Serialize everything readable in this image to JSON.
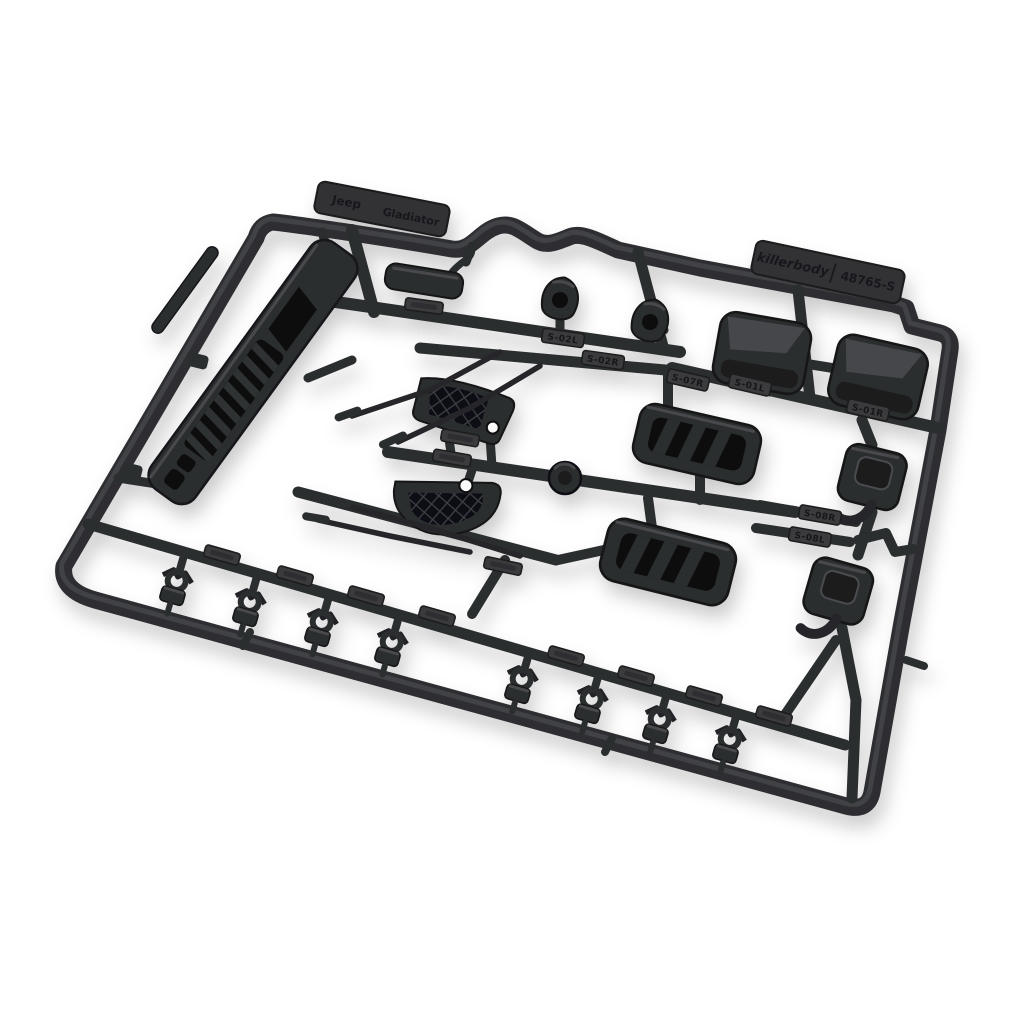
{
  "meta": {
    "type": "product-photograph",
    "subject": "black injection-molded plastic parts sprue (RC car body accessory tree) on white background",
    "background": "#ffffff"
  },
  "colors": {
    "plastic_base": "#2c2d2f",
    "plastic_dark": "#101113",
    "plastic_highlight": "#55575a",
    "tag_plate": "#3a3b3d",
    "engraved_text": "#121314"
  },
  "labels": {
    "model_word1": "Jeep",
    "model_word2": "Gladiator",
    "brand": "killerbody",
    "part_number": "48765-S",
    "s01l": "S-01L",
    "s01r": "S-01R",
    "s02l": "S-02L",
    "s02r": "S-02R",
    "s07r": "S-07R",
    "s08l": "S-08L",
    "s08r": "S-08R"
  }
}
